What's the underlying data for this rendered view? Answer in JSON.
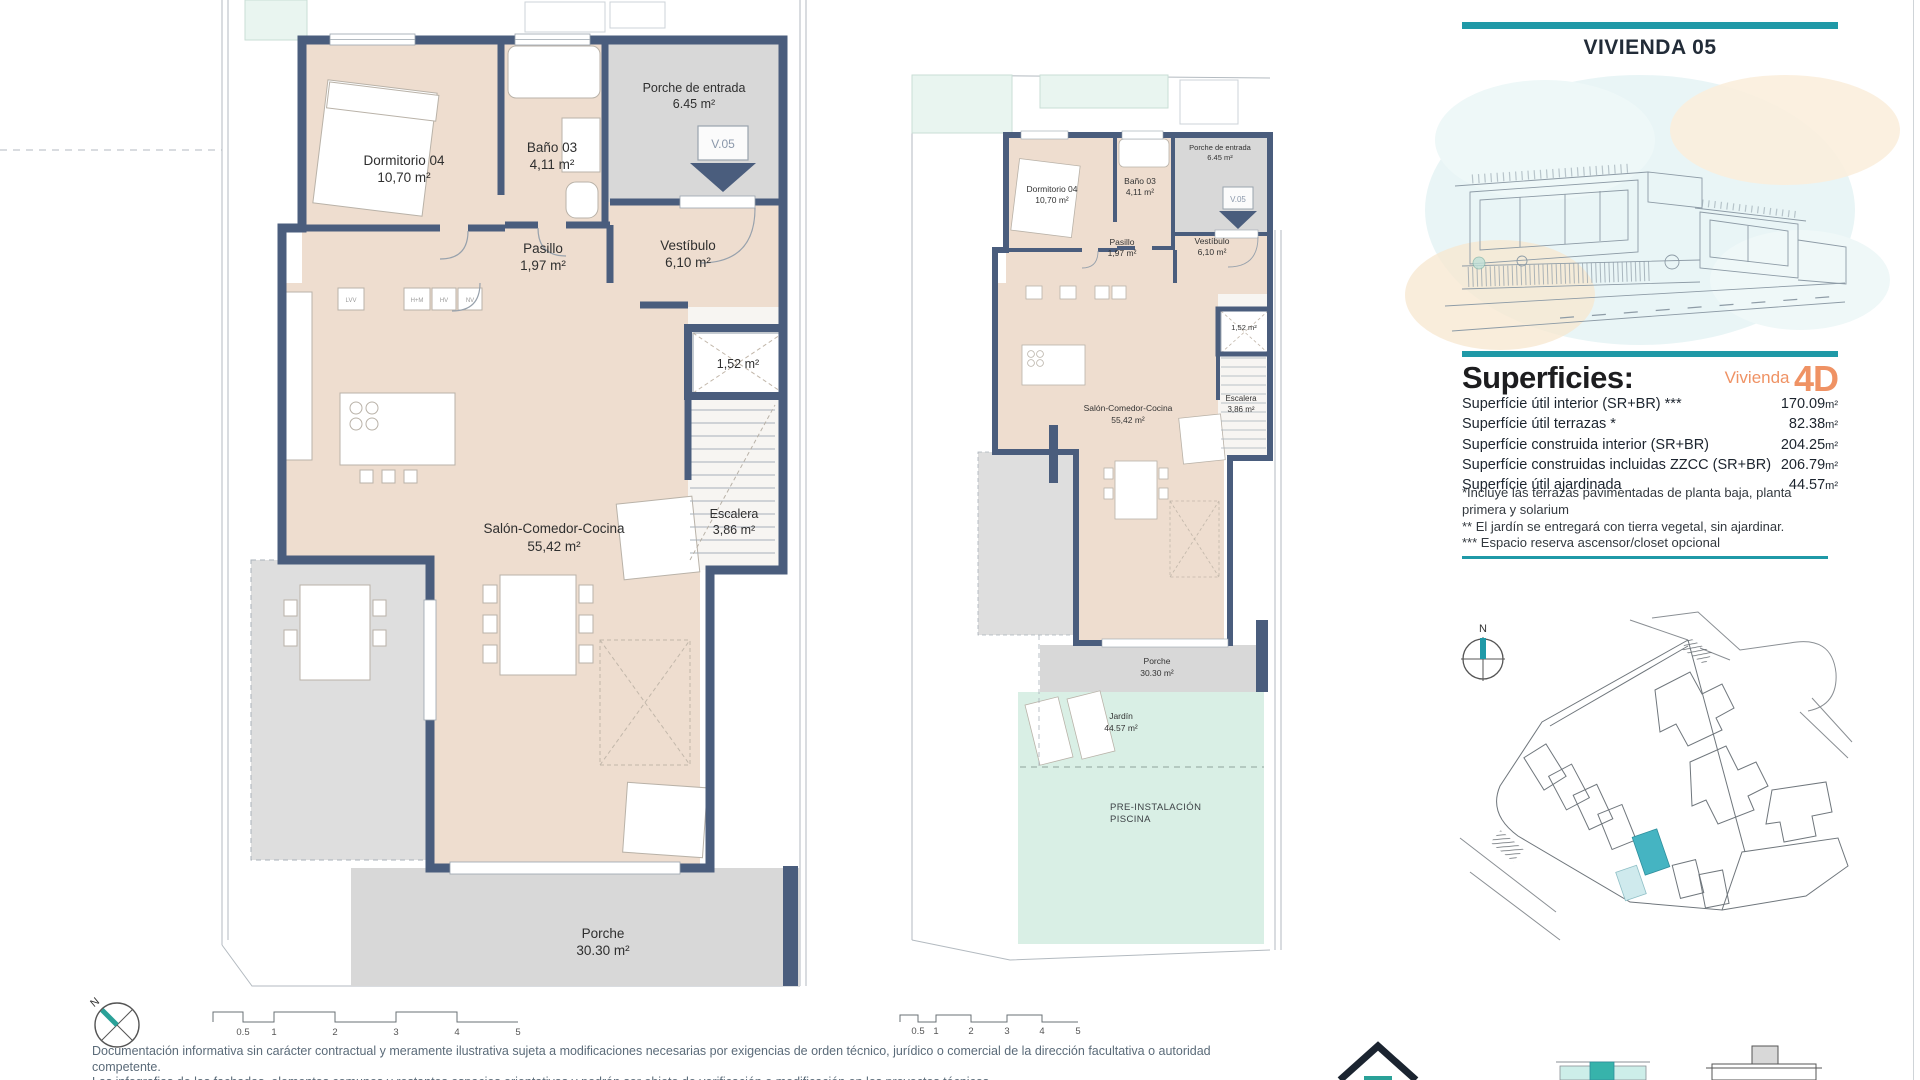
{
  "panel": {
    "title": "VIVIENDA 05",
    "superficies_heading": "Superficies:",
    "vivienda_word": "Vivienda",
    "vivienda_code": "4D",
    "rows": [
      {
        "label": "Superfície útil interior (SR+BR) ***",
        "value": "170.09",
        "unit": "m²"
      },
      {
        "label": "Superfície útil terrazas *",
        "value": "82.38",
        "unit": "m²"
      },
      {
        "label": "Superfície construida interior (SR+BR)",
        "value": "204.25",
        "unit": "m²"
      },
      {
        "label": "Superfície construidas incluidas ZZCC (SR+BR)",
        "value": "206.79",
        "unit": "m²"
      },
      {
        "label": "Superfície útil ajardinada",
        "value": "44.57",
        "unit": "m²"
      }
    ],
    "footnote1a": "*Incluye las terrazas pavimentadas de planta baja, planta",
    "footnote1b": "primera y solarium",
    "footnote2": "** El jardín se entregará con tierra vegetal, sin ajardinar.",
    "footnote3": "*** Espacio reserva ascensor/closet opcional"
  },
  "floorplan": {
    "rooms": {
      "dormitorio_label": "Dormitorio 04",
      "dormitorio_area": "10,70 m²",
      "bano_label": "Baño 03",
      "bano_area": "4,11 m²",
      "porche_entrada_label": "Porche de entrada",
      "porche_entrada_area": "6.45 m²",
      "pasillo_label": "Pasillo",
      "pasillo_area": "1,97 m²",
      "vestibulo_label": "Vestíbulo",
      "vestibulo_area": "6,10 m²",
      "shaft_area": "1,52 m²",
      "salon_label": "Salón-Comedor-Cocina",
      "salon_area": "55,42 m²",
      "escalera_label": "Escalera",
      "escalera_area": "3,86 m²",
      "porche_label": "Porche",
      "porche_area": "30.30 m²"
    },
    "unit_tag": "V.05",
    "kitchen_tags": [
      "LVV",
      "H+M",
      "HV",
      "NV"
    ],
    "garden": {
      "jardin_label": "Jardín",
      "jardin_area": "44.57 m²",
      "piscina_line1": "PRE-INSTALACIÓN",
      "piscina_line2": "PISCINA"
    }
  },
  "siteplan": {
    "north_label": "N"
  },
  "scalebar": {
    "labels": [
      "0.5",
      "1",
      "2",
      "3",
      "4",
      "5"
    ]
  },
  "footer": {
    "north_label": "N",
    "disclaimer_line1": "Documentación informativa sin carácter contractual y meramente ilustrativa sujeta a modificaciones necesarias por exigencias de orden técnico, jurídico o comercial de la dirección facultativa o autoridad competente.",
    "disclaimer_line2": "Las infografias de las fachadas, elementos comunes y restantes espacios orientativas y podrán ser objeto de verificación o modificación en los proyectos técnicos."
  },
  "colors": {
    "accent_teal": "#1f99a7",
    "wall_blue": "#4a5d7d",
    "room_beige": "#eeddcf",
    "porch_gray": "#d8d8d8",
    "garden_mint": "#d9efe5",
    "brand_orange": "#ef9264",
    "site_highlight": "#45b4c2"
  }
}
